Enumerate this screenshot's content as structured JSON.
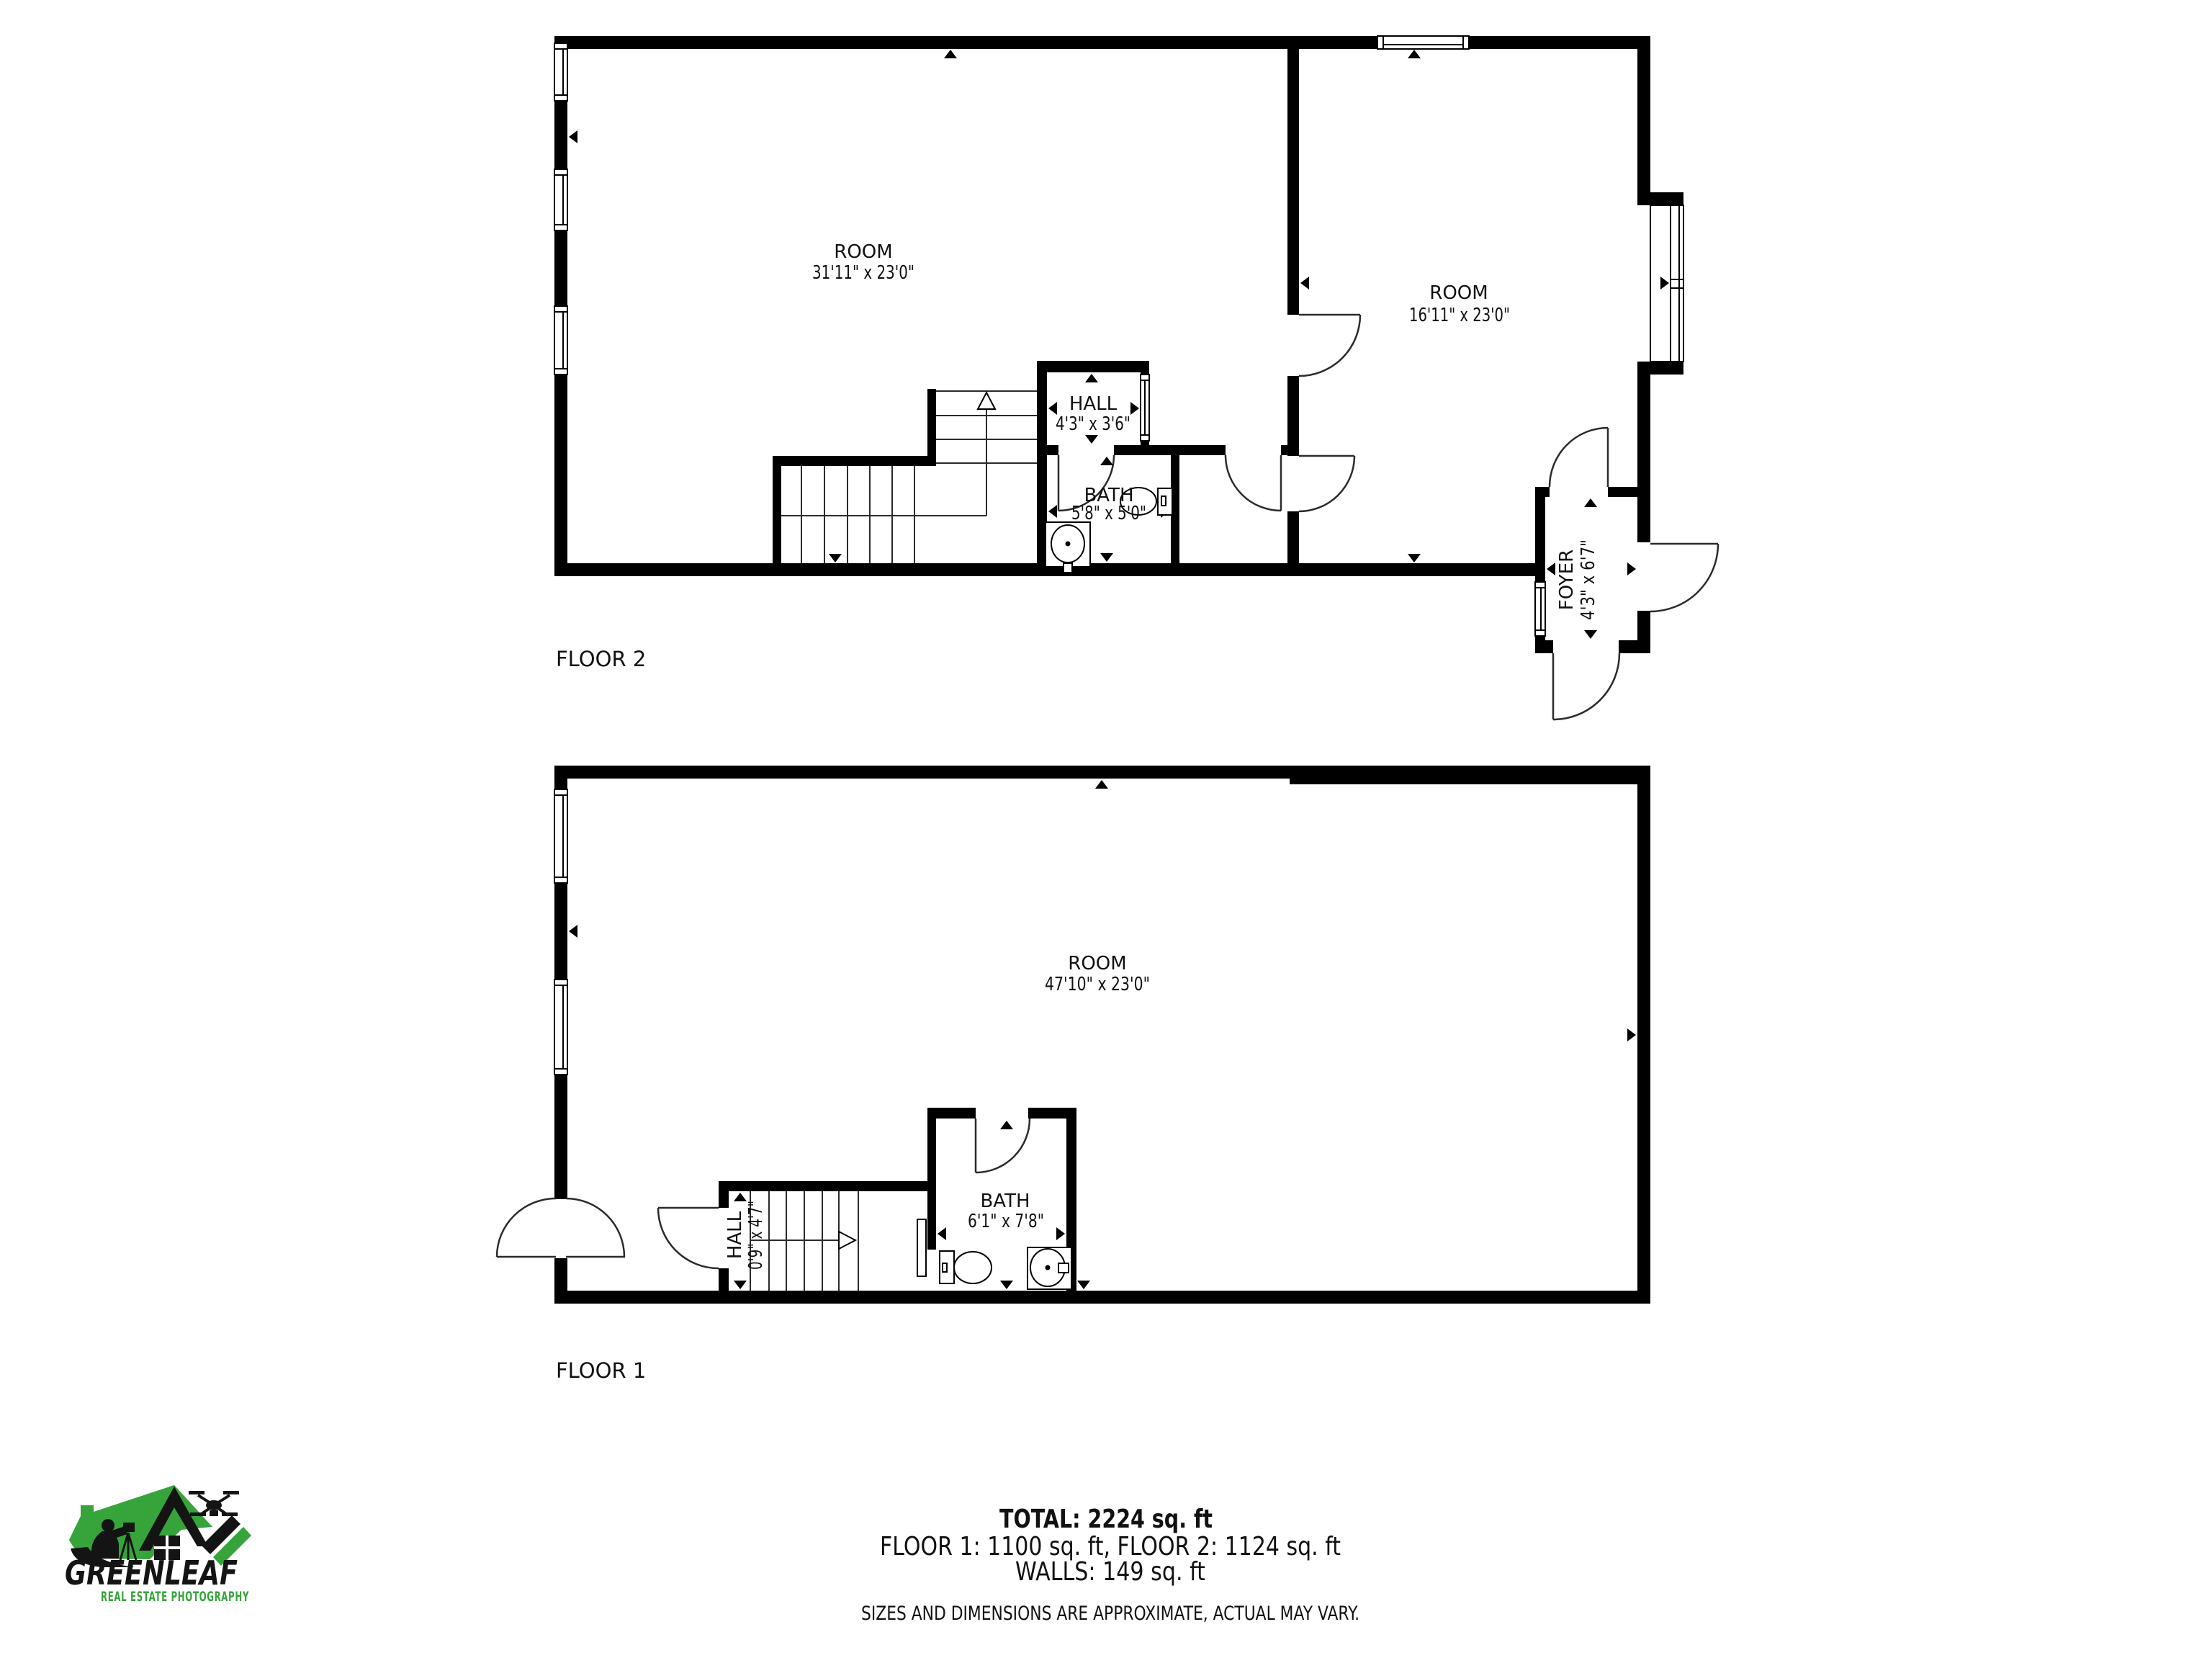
{
  "floor2": {
    "label": "FLOOR 2",
    "room_left": {
      "name": "ROOM",
      "dims": "31'11\" x 23'0\""
    },
    "room_right": {
      "name": "ROOM",
      "dims": "16'11\" x 23'0\""
    },
    "hall": {
      "name": "HALL",
      "dims": "4'3\" x 3'6\""
    },
    "bath": {
      "name": "BATH",
      "dims": "5'8\" x 5'0\""
    },
    "foyer": {
      "name": "FOYER",
      "dims": "4'3\" x 6'7\""
    }
  },
  "floor1": {
    "label": "FLOOR 1",
    "room": {
      "name": "ROOM",
      "dims": "47'10\" x 23'0\""
    },
    "bath": {
      "name": "BATH",
      "dims": "6'1\" x 7'8\""
    },
    "hall": {
      "name": "HALL",
      "dims": "0'9\" x 4'7\""
    }
  },
  "summary": {
    "total": "TOTAL: 2224 sq. ft",
    "floors": "FLOOR 1: 1100 sq. ft, FLOOR 2: 1124 sq. ft",
    "walls": "WALLS: 149 sq. ft",
    "disclaimer": "SIZES AND DIMENSIONS ARE APPROXIMATE, ACTUAL MAY VARY."
  },
  "logo": {
    "name": "GREENLEAF",
    "tagline": "REAL ESTATE PHOTOGRAPHY",
    "colors": {
      "green": "#36A43A",
      "black": "#141414",
      "wall": "#000000"
    }
  }
}
